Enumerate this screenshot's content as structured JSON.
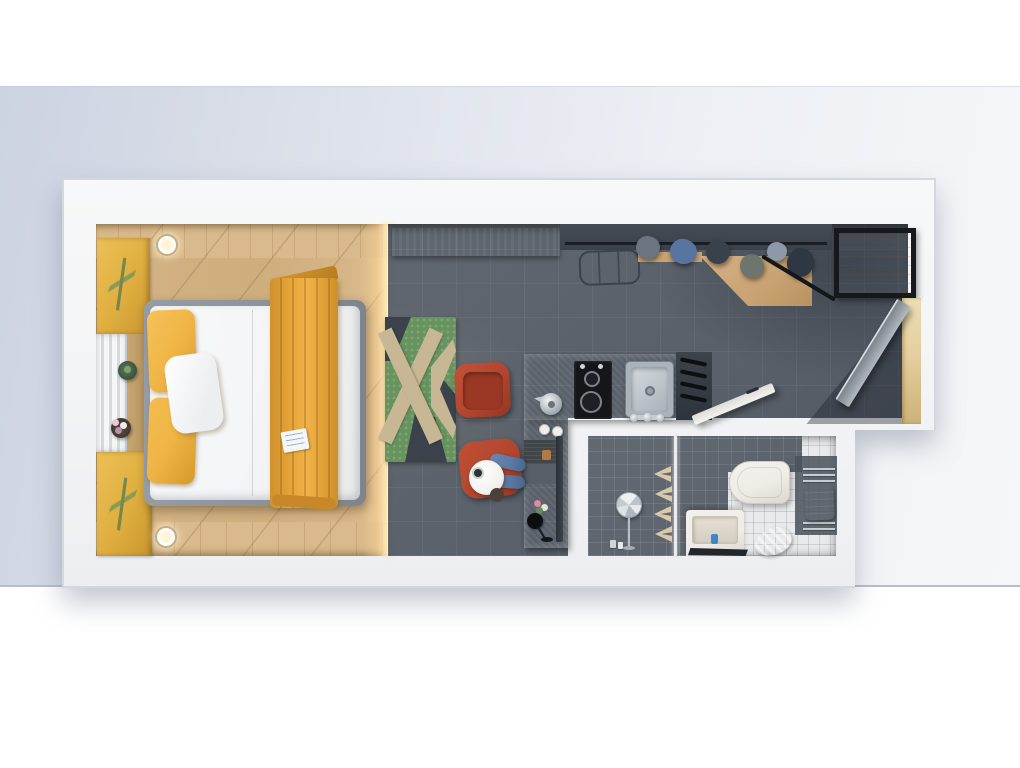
{
  "scene": {
    "type": "3d-floor-plan-top-view",
    "subject": "studio-apartment",
    "rooms": [
      {
        "name": "bedroom",
        "items": [
          "double-bed",
          "bed-frame",
          "white-duvet",
          "yellow-pillow-top",
          "yellow-pillow-bottom",
          "white-pillow",
          "yellow-throw-blanket",
          "menu-card",
          "wall-art-panel-top",
          "wall-art-panel-bottom",
          "window-strip",
          "window-ledge",
          "cactus-plant",
          "flower-plant",
          "ceiling-light-top",
          "ceiling-light-bottom",
          "wood-floor"
        ]
      },
      {
        "name": "living-area",
        "items": [
          "dark-tile-floor",
          "x-pattern-rug",
          "red-armchair",
          "red-desk-chair",
          "seated-person",
          "wall-tv-panel",
          "suitcase",
          "floor-glow-strip"
        ]
      },
      {
        "name": "kitchen",
        "items": [
          "l-shaped-counter",
          "two-burner-cooktop",
          "burner-large",
          "burner-small",
          "kettle",
          "coffee-cups",
          "steel-sink",
          "drain",
          "faucet",
          "knife-slat-rack",
          "placemat-laptop",
          "counter-edge-bar",
          "small-flowers",
          "black-wine-glass"
        ]
      },
      {
        "name": "entry",
        "items": [
          "open-wardrobe-rack",
          "hanger-rail",
          "hanging-clothes",
          "wood-shelf",
          "black-frame-console-table",
          "open-entry-door",
          "lit-door-jamb",
          "door-floor-shadow"
        ]
      },
      {
        "name": "bathroom",
        "items": [
          "shower-dark-tiles",
          "glass-partition",
          "round-shower-mirror",
          "shampoo-bottles",
          "decor-chevrons",
          "vanity-sink",
          "soap-bottle",
          "black-floor-mat",
          "toilet",
          "towel-radiator",
          "white-towel",
          "blue-towel",
          "open-bathroom-door"
        ]
      }
    ],
    "palette": {
      "backdrop-left": "#ccd3e1",
      "backdrop-right": "#f6f7fa",
      "wall": "#f3f5f7",
      "wall-edge": "#d3d8de",
      "wood": "#cfae7d",
      "wood-band": "#d9ba8c",
      "glow": "#ffe9bd",
      "tile": "#59606a",
      "art-yellow": "#dfae3f",
      "leaf-green": "#75874b",
      "bed-frame": "#8b9198",
      "duvet": "#f4f5f7",
      "pillow-yellow": "#efb445",
      "throw-yellow": "#e8a73c",
      "chair-red": "#b2452f",
      "chair-red-deep": "#9a3825",
      "rug-green": "#67935e",
      "rug-tan": "#c8b795",
      "rug-dark": "#3b424b",
      "counter": "#bcbfc1",
      "cooktop": "#141619",
      "steel": "#aab3ba",
      "steel-light": "#d4dade",
      "suitcase": "#4e5864",
      "wardrobe-wood": "#c9a273",
      "clothes-gray": "#6b7480",
      "clothes-denim": "#5874a0",
      "clothes-dark": "#39424c",
      "clothes-navy": "#2e3744",
      "clothes-sage": "#6d756e",
      "clothes-light": "#8d99a8",
      "door-gray": "#9aa1a8",
      "jamb-tan": "#e4cf9f",
      "bath-tile-light": "#e8e9eb",
      "bath-tile-dark": "#59606a",
      "fixture-white": "#efece6",
      "chrome": "#c5cdd2",
      "towel-blue": "#a9d8e3",
      "denim": "#5b79a3",
      "shirt": "#f2f1ee",
      "shadow": "rgba(30,36,46,0.4)"
    }
  }
}
